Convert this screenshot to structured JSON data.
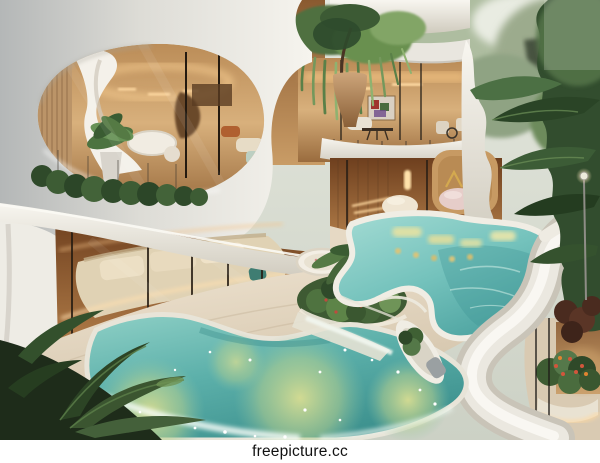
{
  "image": {
    "kind": "photograph-render",
    "description": "Multi-level luxury villa with organic white curved balconies, warm-lit glass interiors, a two-tier turquoise lagoon pool with glowing underwater lights, a floating white lounger boat, cascading ferns, palm trees and dense tropical foliage.",
    "width_px": 600,
    "height_px": 463
  },
  "watermark": {
    "text": "freepicture.cc"
  },
  "palette": {
    "facade_white": "#eFeCe4",
    "slab_shadow": "#c7c2b6",
    "interior_warm": "#b9854e",
    "interior_glow": "#ffd9a0",
    "pool_turquoise": "#7ec7c2",
    "pool_deep": "#3f9694",
    "pool_glow_green": "#cdd98e",
    "travertine": "#e2d5c0",
    "foliage_dark": "#2c4425",
    "foliage_light": "#7da368",
    "flower_red": "#c9503c",
    "accent_gold": "#d4a94f",
    "sky_haze": "#dfe3da"
  },
  "scene": {
    "regions": [
      "sky-haze",
      "bright-tree-canopy",
      "upper-balcony-stack",
      "gold-chandelier",
      "hanging-ferns",
      "planter-vase",
      "mid-level-interior",
      "wall-art",
      "dining-set",
      "balcony-chairs",
      "oval-lounge-opening",
      "curtains",
      "sculptural-stair",
      "indoor-plant",
      "balcony-hedge",
      "stairwell-room",
      "alcove-nook",
      "gold-peak-mark",
      "stone-poufs",
      "ground-floor-lounge",
      "sectional-sofa",
      "led-strips",
      "spa-tub",
      "travertine-terrace",
      "palm-island",
      "upper-pool",
      "underwater-lights",
      "white-ribbon-deck",
      "lower-pool",
      "pool-glow",
      "cascade-foam",
      "lounger-boat",
      "bottom-left-palm",
      "right-tropical-foliage",
      "flower-planter",
      "street-lamp"
    ]
  }
}
